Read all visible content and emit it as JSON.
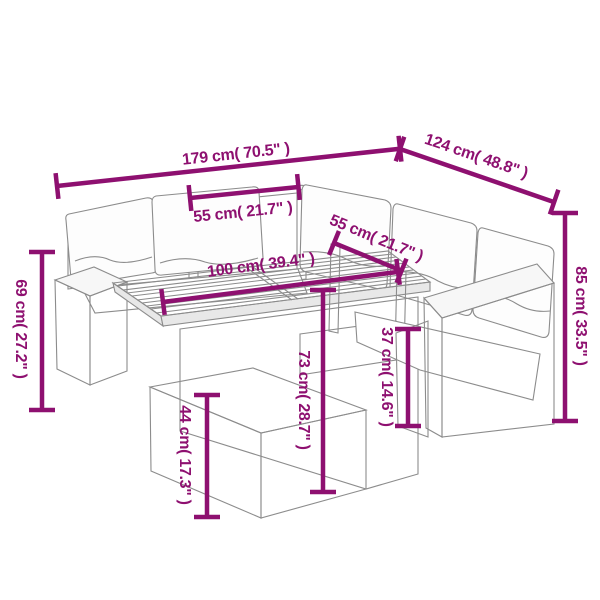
{
  "diagram": {
    "kind": "product dimension diagram",
    "subject": "poly rattan corner garden sofa set with slatted-top table and footstool"
  },
  "colors": {
    "dimension_accent": "#8E1070",
    "line_art_gray": "#8C8C8C",
    "background": "#FFFFFF"
  },
  "dimensions": {
    "total_width": "179 cm( 70.5\" )",
    "total_depth": "124 cm( 48.8\" )",
    "seat_width_left": "55 cm( 21.7\" )",
    "seat_width_right": "55 cm( 21.7\" )",
    "table_length": "100 cm( 39.4\" )",
    "backrest_height": "85 cm( 33.5\" )",
    "armrest_height": "69 cm( 27.2\" )",
    "table_height": "73 cm( 28.7\" )",
    "seat_height": "37 cm( 14.6\" )",
    "footstool_height": "44 cm( 17.3\" )"
  }
}
